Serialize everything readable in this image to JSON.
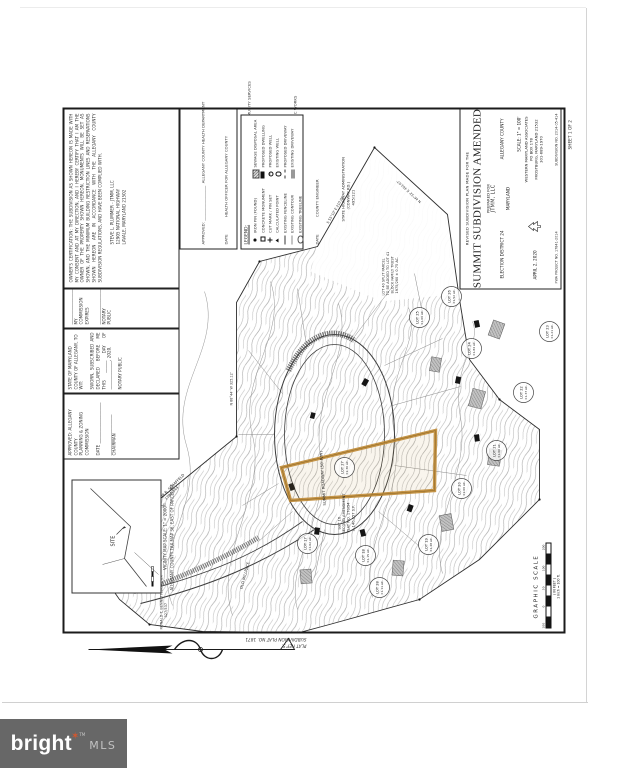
{
  "watermark": {
    "brand": "bright",
    "tm": "TM",
    "mls": "MLS"
  },
  "sheet_margin": {
    "plat_ref1": "PLAT REF'S.",
    "plat_ref2": "SUBDIVISION PLAT NO. 1871",
    "sheet_no": "SHEET 1 OF 2"
  },
  "vicinity": {
    "site": "SITE",
    "caption1": "VICINITY MAP    SCALE: 1\" = 2000'",
    "caption2": "ALLEGANY COUNTY TAX MAP 36, EAST OF PARCEL 88"
  },
  "certifications": {
    "planning": {
      "l1": "APPROVED: ALLEGANY COUNTY",
      "l2": "PLANNING & ZONING COMMISSION",
      "l3": "DATE  ____________________",
      "l4": "____________________  CHAIRMAN"
    },
    "notary": {
      "l1": "STATE OF MARYLAND",
      "l2": "COUNTY OF ALLEGANY, TO WIT:",
      "p": "SWORN, SUBSCRIBED AND DECLARED BEFORE ME THIS ______ DAY OF ______________, 2020.",
      "l3": "NOTARY PUBLIC"
    },
    "commission": {
      "l1": "__________________",
      "l2": "MY COMMISSION EXPIRES",
      "l3": "__________________",
      "l4": "NOTARY PUBLIC"
    },
    "owner": {
      "p": "OWNER'S CERTIFICATION:  THE SUBDIVISION AS SHOWN HEREON IS MADE WITH MY CONSENT AND AT MY DIRECTION, AND I HEREBY CERTIFY THAT I AM THE OWNER OF THE PROPERTY SHOWN HEREON. MONUMENTS WILL BE SET AS SHOWN, AND THE MINIMUM BUILDING RESTRICTION LINES AND RESERVATIONS SHOWN HEREON ARE IN ACCORDANCE WITH THE ALLEGANY COUNTY SUBDIVISION REGULATIONS, AND HAVE BEEN COMPLIED WITH.",
      "sig1": "STEVE L. PLUMMER  -  JTMM, LLC",
      "sig2": "12905 NATIONAL HIGHWAY",
      "sig3": "LAVALE, MARYLAND  21502"
    }
  },
  "approvals": {
    "lines": [
      "APPROVED: __________________  ALLEGANY COUNTY HEALTH DEPARTMENT",
      "DATE              HEALTH OFFICER FOR ALLEGANY COUNTY",
      "APPROVED: __________________  ALLEGANY COUNTY DEPT. OF COMMUNITY SERVICES",
      "DATE              LAND USE & PLANNING ENGINEER",
      "APPROVED: __________________  ALLEGANY COUNTY DEPT. OF PUBLIC WORKS",
      "DATE              COUNTY ENGINEER"
    ]
  },
  "legend": {
    "title": "LEGEND:",
    "col1": [
      {
        "sym": "iron-pin-dot",
        "label": "IRON PIN (FOUND)"
      },
      {
        "sym": "concrete-monument-square",
        "label": "CONCRETE MONUMENT"
      },
      {
        "sym": "cut-mark-cross",
        "label": "CUT MARK / PIN SET"
      },
      {
        "sym": "calculated-point-triangle",
        "label": "CALCULATED POINT"
      },
      {
        "sym": "fence-line",
        "label": "EXISTING FENCELINE"
      },
      {
        "sym": "contour-line",
        "label": "EXISTING CONTOUR"
      },
      {
        "sym": "tree-line",
        "label": "EXISTING TREELINE"
      }
    ],
    "col2": [
      {
        "sym": "hatched-box",
        "label": "SEWAGE DISPOSAL AREA"
      },
      {
        "sym": "solid-box",
        "label": "PROPOSED DWELLING"
      },
      {
        "sym": "well-dot-circle",
        "label": "PROPOSED WELL"
      },
      {
        "sym": "open-circle",
        "label": "EXISTING WELL"
      },
      {
        "sym": "dashed-line",
        "label": "PROPOSED DRIVEWAY"
      },
      {
        "sym": "double-line",
        "label": "EXISTING DRIVEWAY"
      }
    ]
  },
  "title_block": {
    "line1": "REVISED SUBDIVISION PLAN MADE FOR THE",
    "title": "SUMMIT SUBDIVISION AMENDED",
    "prepared_for": "PREPARED FOR",
    "client": "JTMM, LLC",
    "district": "ELECTION DISTRICT 24",
    "county": "ALLEGANY COUNTY",
    "state": "MARYLAND",
    "scale": "SCALE: 1\" = 100'",
    "date": "APRIL 2, 2020",
    "firm": "WESTERN MARYLAND ASSOCIATES",
    "firm_addr1": "PO BOX 178",
    "firm_addr2": "FROSTBURG, MARYLAND  21532",
    "firm_phone": "301-689-1970",
    "project_no": "FWA PROJECT NO. 17841-2014",
    "subdivision_no": "SUBDIVISION NO. 2014-05-414"
  },
  "graphic_scale": {
    "label": "GRAPHIC SCALE",
    "t0": "100",
    "t1": "0",
    "t2": "50",
    "t3": "100",
    "t4": "200",
    "units": "( IN FEET )",
    "note": "1 inch = 100 ft."
  },
  "map": {
    "sha1": "STATE HIGHWAY ADMINISTRATION",
    "sha2": "(CONWAY RD.)",
    "sha3": "495/121",
    "schaffeld1": "ARTHUR R. SCHAFFELD",
    "schaffeld2": "1781/344",
    "bennett1": "RONALD T. BENNETT, JR. ET UX",
    "bennett2": "327/537",
    "lot16_1": "LOT 16",
    "lot16_2": "SECOND AMENDMENT",
    "lot16_3": "PLAT NO. 170/54",
    "lot16_4": "± 140,657 S.F.",
    "trust1": "LOT 40 SPLIT PARCEL",
    "trust2": "TO BE ADDED TO LOT 41",
    "trust3": "BLOCK FAMILY TRUST",
    "trust4": "1975/260   ± 0.75 AC.",
    "road_loop": "SUMMIT ROADWAY   (50' R/W)",
    "road_millrace": "OLD MILLRACE",
    "bearings": [
      "N 46°32' E   403.67'",
      "S 55°10' E   210.00'",
      "N 88°44' W   325.12'",
      "S 62°45' W   187.30'"
    ],
    "lots": [
      {
        "name": "LOT 17",
        "area": "±1.02 AC."
      },
      {
        "name": "LOT 18",
        "area": "±1.15 AC."
      },
      {
        "name": "LOT 19",
        "area": "±1.48 AC."
      },
      {
        "name": "LOT 20",
        "area": "±2.06 AC."
      },
      {
        "name": "LOT 21",
        "area": "±1.00 AC."
      },
      {
        "name": "LOT 22",
        "area": "±1.37 AC."
      },
      {
        "name": "LOT 23",
        "area": "±1.21 AC."
      },
      {
        "name": "LOT 24",
        "area": "±1.84 AC."
      },
      {
        "name": "LOT 25",
        "area": "±1.06 AC."
      },
      {
        "name": "LOT 26",
        "area": "±1.52 AC."
      },
      {
        "name": "LOT 27",
        "area": "±2.30 AC."
      },
      {
        "name": "LOT 28",
        "area": "±1.11 AC."
      }
    ]
  }
}
